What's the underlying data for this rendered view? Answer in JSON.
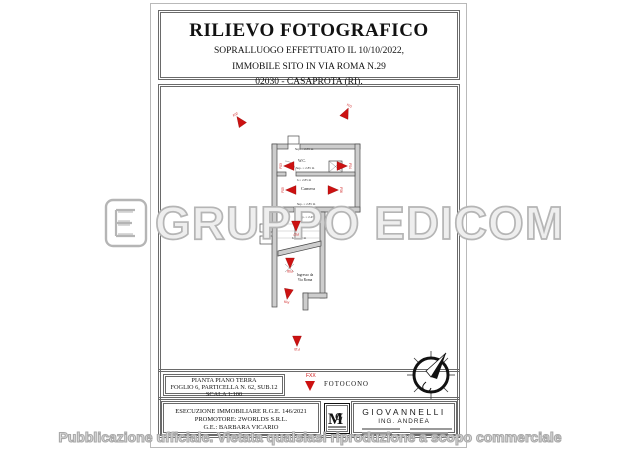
{
  "title_block": {
    "title": "RILIEVO FOTOGRAFICO",
    "subtitle_lines": [
      "SOPRALLUOGO EFFETTUATO IL 10/10/2022,",
      "IMMOBILE SITO IN VIA ROMA N.29",
      "02030 - CASAPROTA (RI)."
    ]
  },
  "plan": {
    "room_labels": [
      {
        "text": "W.C.",
        "x": 144,
        "y": 78,
        "size": 4
      },
      {
        "text": "Camera",
        "x": 150,
        "y": 106,
        "size": 4.5
      },
      {
        "text": "Ingresso da",
        "x": 147,
        "y": 192,
        "size": 3.6
      },
      {
        "text": "Via Roma",
        "x": 147,
        "y": 197,
        "size": 3.6
      }
    ],
    "annotations": [
      {
        "text": "Sup. = 2.55 m",
        "x": 146,
        "y": 66
      },
      {
        "text": "Sup. = 2.85 m",
        "x": 147,
        "y": 85
      },
      {
        "text": "h = 2.85 m",
        "x": 146,
        "y": 97
      },
      {
        "text": "Sup. = 2.85 m",
        "x": 148,
        "y": 121
      },
      {
        "text": "Sup. = 2.45 m",
        "x": 150,
        "y": 134
      },
      {
        "text": "h = 2.80 m",
        "x": 141,
        "y": 155
      }
    ],
    "markers": [
      {
        "label": "F01",
        "x": 188,
        "y": 29,
        "angle": 25
      },
      {
        "label": "F02",
        "x": 82,
        "y": 37,
        "angle": -35
      },
      {
        "label": "F03",
        "x": 131,
        "y": 82,
        "angle": -90
      },
      {
        "label": "F04",
        "x": 184,
        "y": 82,
        "angle": 90
      },
      {
        "label": "F05",
        "x": 133,
        "y": 106,
        "angle": -90
      },
      {
        "label": "F06",
        "x": 175,
        "y": 106,
        "angle": 90
      },
      {
        "label": "F07",
        "x": 138,
        "y": 142,
        "angle": 180
      },
      {
        "label": "F08",
        "x": 132,
        "y": 179,
        "angle": 180
      },
      {
        "label": "F09",
        "x": 130,
        "y": 210,
        "angle": 190
      },
      {
        "label": "F10",
        "x": 139,
        "y": 257,
        "angle": 180
      }
    ]
  },
  "plan_info_box": {
    "lines": [
      "PIANTA PIANO TERRA",
      "FOGLIO 6, PARTICELLA N. 62, SUB.12",
      "SCALA 1:100"
    ]
  },
  "legend": {
    "code": "FXX",
    "label": "FOTOCONO"
  },
  "execution_box": {
    "lines": [
      "ESECUZIONE IMMOBILIARE R.G.E. 146/2021",
      "PROMOTORE: 2WORLDS S.R.L.",
      "G.E.: BARBARA VICARIO"
    ]
  },
  "surveyor_box": {
    "name": "GIOVANNELLI",
    "title": "ING. ANDREA"
  },
  "watermarks": {
    "brand": "GRUPPO EDICOM",
    "notice": "Pubblicazione ufficiale. Vietata qualsiasi riproduzione a scopo commerciale"
  },
  "colors": {
    "marker_red": "#cc1111",
    "wall_fill": "#cdcdcd",
    "wall_stroke": "#4a4a4a",
    "border": "#666666",
    "watermark_gray": "#b5b5b5"
  }
}
